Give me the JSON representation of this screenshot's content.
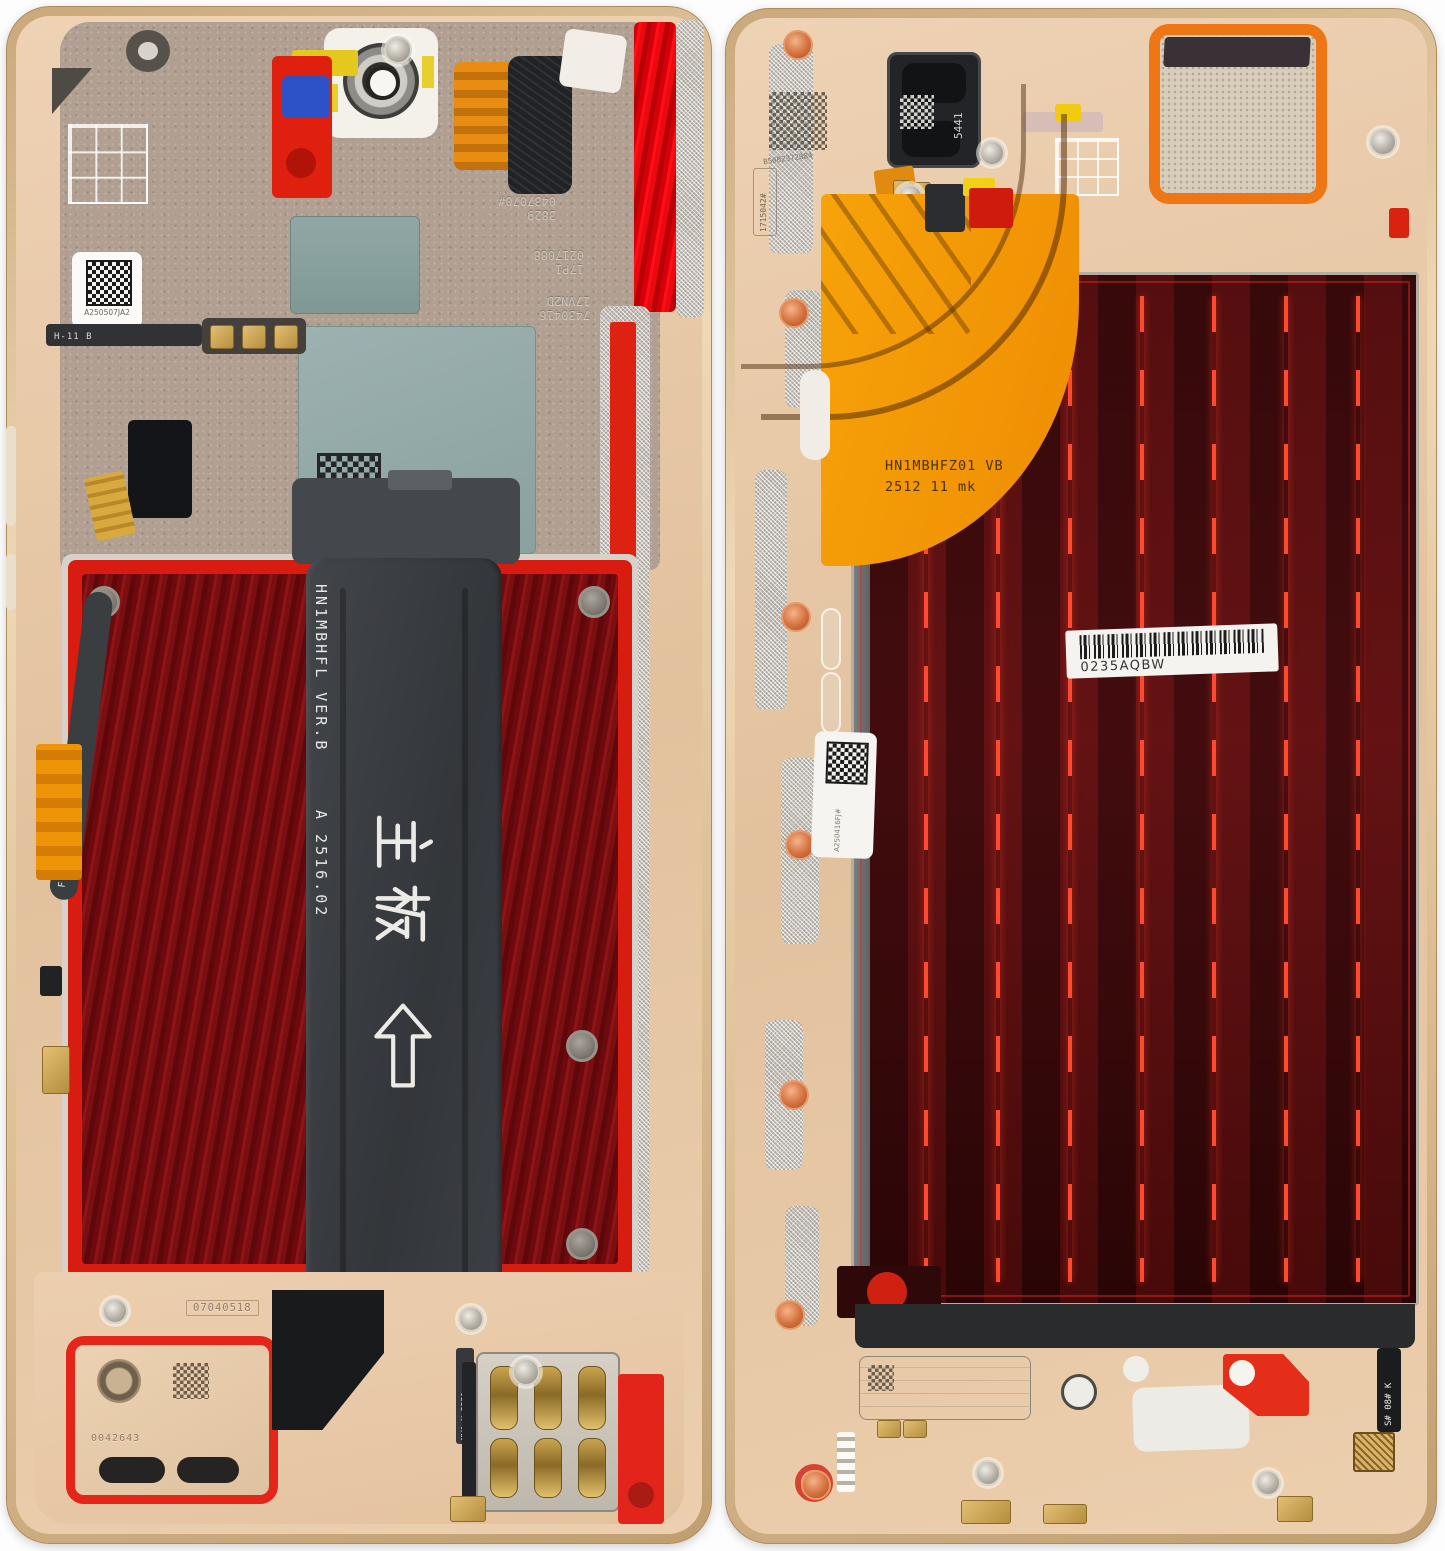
{
  "left": {
    "top_codes": {
      "l1a": "3829",
      "l1b": "0437070#",
      "l2a": "17P1",
      "l2b": "0217088",
      "mid": "007",
      "r1": "7430416",
      "r2": "17VN2D"
    },
    "labels": {
      "datamatrix": "A250507JA2",
      "speaker_area": "07040518",
      "speaker": "0042643"
    },
    "flex": {
      "side": "F4B14 RA0  K251737",
      "small": "H-11 B",
      "sim": "MVA  H-2521"
    },
    "main_flex": {
      "code": "HN1MBHFL VER.B",
      "rev": "A 2516.02",
      "cn": "主板",
      "arrow": "↑"
    }
  },
  "right": {
    "codes": {
      "datamatrix": "B5002372084",
      "vertical": "1715042#",
      "earpiece": "5441"
    },
    "orange_flex": {
      "line1": "HN1MBHFZ01 VB",
      "line2": "2512 11  mk"
    },
    "barcode": {
      "text": "0235AQBW"
    },
    "labels": {
      "datamatrix": "A250416FJ#",
      "bottom": "S# 08# K"
    }
  },
  "colors": {
    "frame_gold": "#d9b98e",
    "plate_champagne": "#e9cdaf",
    "adhesive_red": "#e02214",
    "battery_well_red": "#7c0e10",
    "display_maroon": "#470b0e",
    "flex_orange": "#f59b04",
    "shield_teal": "#93aaa8",
    "flex_dark": "#3e4145"
  }
}
